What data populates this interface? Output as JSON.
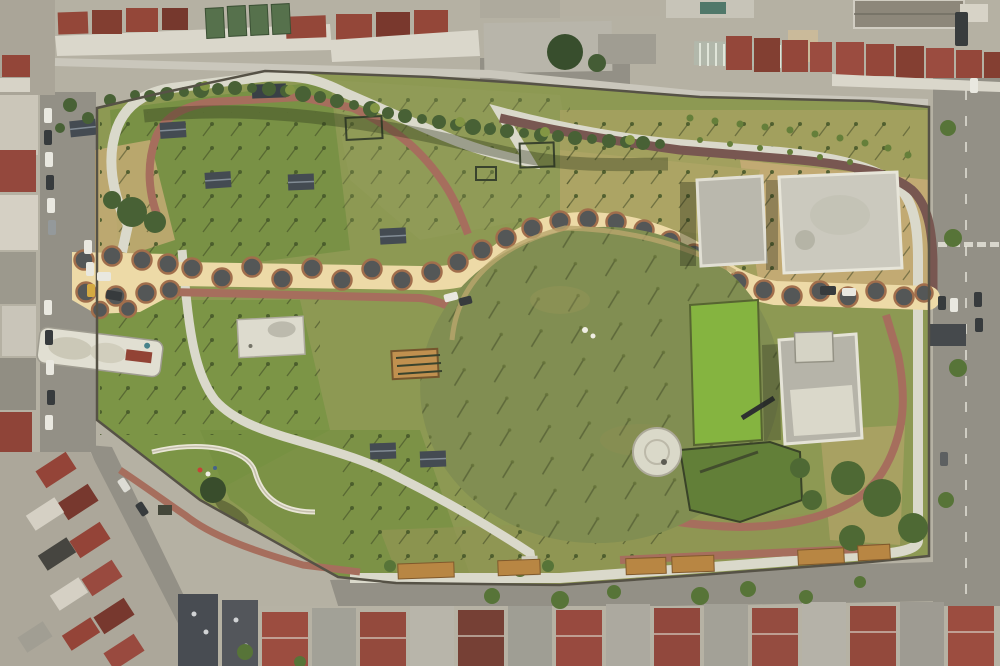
{
  "image": {
    "width": 1000,
    "height": 666
  },
  "scene": {
    "type": "aerial-photograph",
    "subject": "Top-down drone view of a large newly built urban park surrounded by city apartment blocks",
    "time_of_day": "daytime",
    "park_features": [
      "polka-dot promenade with circular tree pits",
      "large central oval lawn with young saplings",
      "white concrete loop path",
      "red brick walking paths",
      "flat white-roof pavilion buildings",
      "bright green pond terrace with footbridge",
      "round white gazebo",
      "winding playground slide",
      "rows of newly planted trees",
      "orange wooden boundary fences"
    ],
    "surroundings": [
      "apartment blocks with red tile roofs",
      "blocks with green metal roofs",
      "perimeter streets with parked cars",
      "dense housing at bottom-left and bottom edge"
    ]
  },
  "palette": {
    "cityBase": "#b2aea4",
    "road": "#8e8c85",
    "roadLight": "#c8c6be",
    "roofRed": "#8f3f34",
    "roofRedDark": "#6f2f28",
    "roofGreen": "#4d6b48",
    "roofGray": "#9c9a93",
    "roofNavy": "#424854",
    "facadeWhite": "#d9d6ce",
    "parkBase": "#879550",
    "grassBright": "#6f8c3e",
    "grassOlive": "#a49e5e",
    "dirt": "#c2a873",
    "oval": "#7b8a4e",
    "pathWhite": "#d9d8ce",
    "pathBrick": "#a2685a",
    "pathDark": "#71504d",
    "promenade": "#ecdaa8",
    "promenadeDot": "#4b5054",
    "promenadeRing": "#9c6848",
    "pondBright": "#7fb13c",
    "pondDark": "#5a7a33",
    "buildingRoof": "#c9c8c0",
    "buildingTrim": "#e8e7df",
    "cabin": "#3a434f",
    "wood": "#b5813f",
    "treeDark": "#3f5a30",
    "treeLight": "#7d9240",
    "wall": "#4d4a42",
    "carWhite": "#e8e8e4",
    "carDark": "#2d3238",
    "carYellow": "#d2a73e"
  }
}
